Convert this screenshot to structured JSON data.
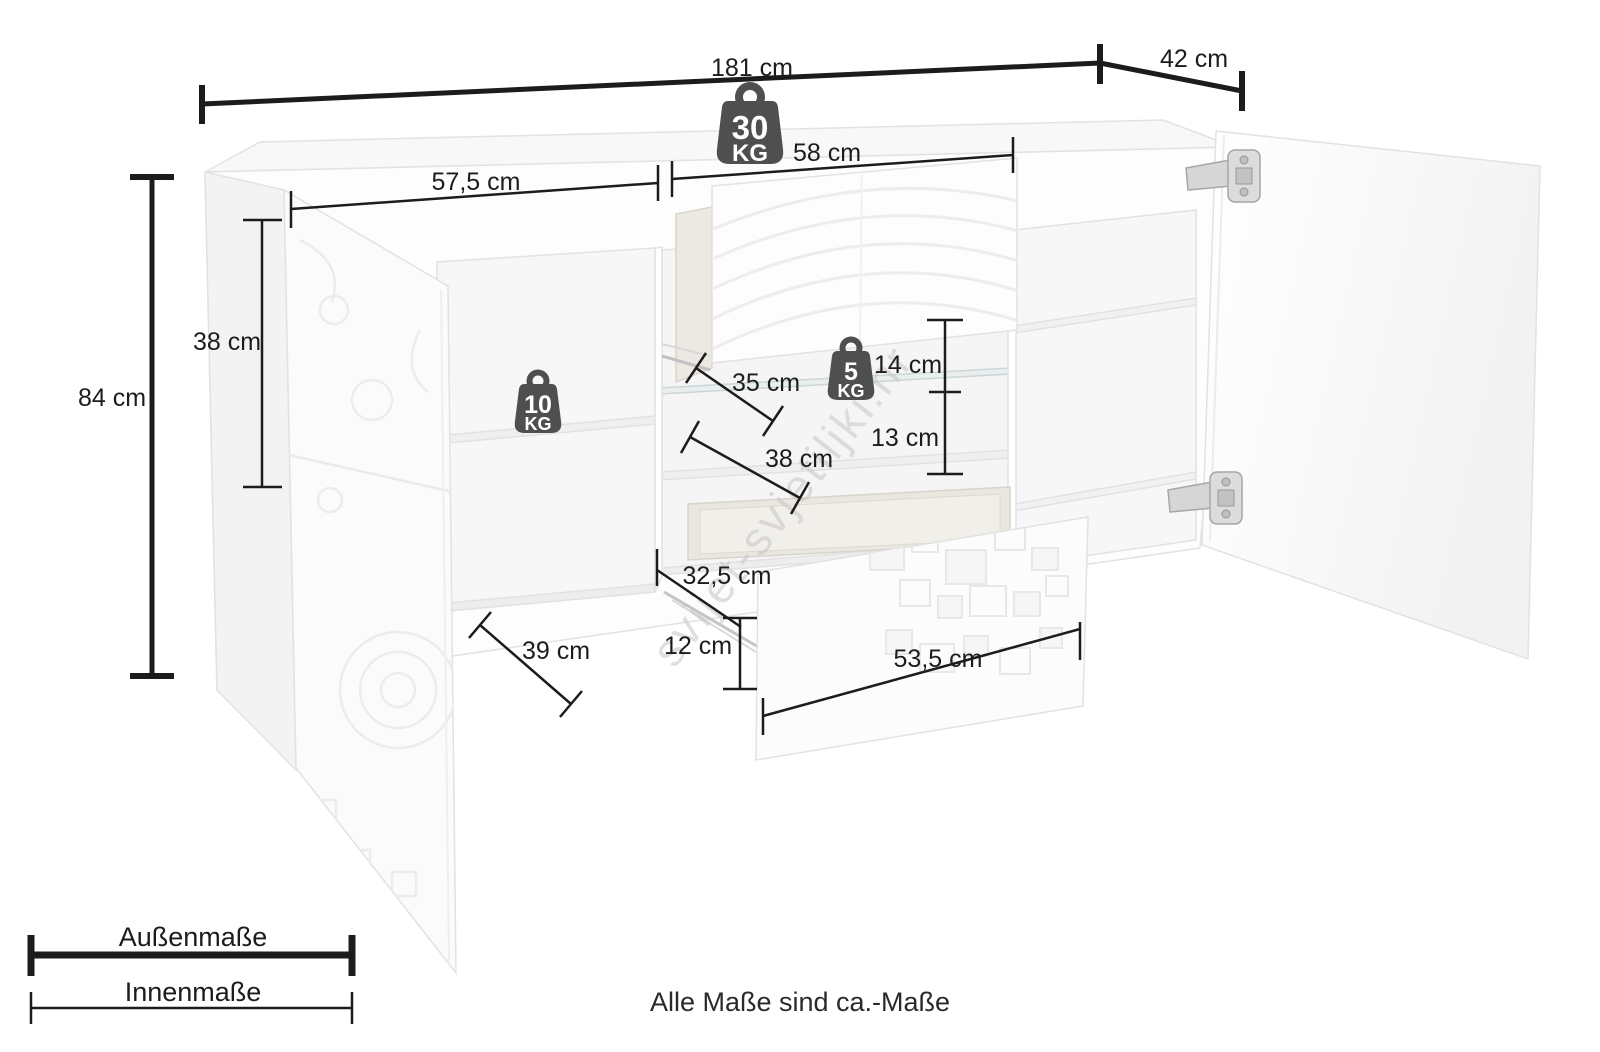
{
  "page": {
    "footer_note": "Alle Maße sind ca.-Maße",
    "watermark": "svijet-svjetiljki.hr",
    "unit": "cm",
    "background": "#ffffff"
  },
  "legend": {
    "outer": "Außenmaße",
    "inner": "Innenmaße"
  },
  "weights": {
    "top": {
      "value": "30",
      "unit": "KG"
    },
    "shelf_left": {
      "value": "10",
      "unit": "KG"
    },
    "shelf_glass": {
      "value": "5",
      "unit": "KG"
    }
  },
  "dims": {
    "outer": {
      "total_width": "181 cm",
      "depth": "42 cm",
      "height": "84 cm"
    },
    "inner": {
      "left_height": "38 cm",
      "left_width": "57,5 cm",
      "middle_width": "58 cm",
      "glass_shelf_depth": "35 cm",
      "lower_shelf_depth": "38 cm",
      "above_glass_height": "14 cm",
      "below_glass_height": "13 cm",
      "drawer_depth": "32,5 cm",
      "drawer_height": "12 cm",
      "drawer_width": "53,5 cm",
      "bottom_depth": "39 cm"
    }
  },
  "colors": {
    "dimension_line": "#1c1c1c",
    "weight_badge": "#4f4f4f",
    "weight_badge_text": "#ffffff",
    "furniture_edge": "#e2e2e2",
    "watermark": "#c6c6c6"
  }
}
